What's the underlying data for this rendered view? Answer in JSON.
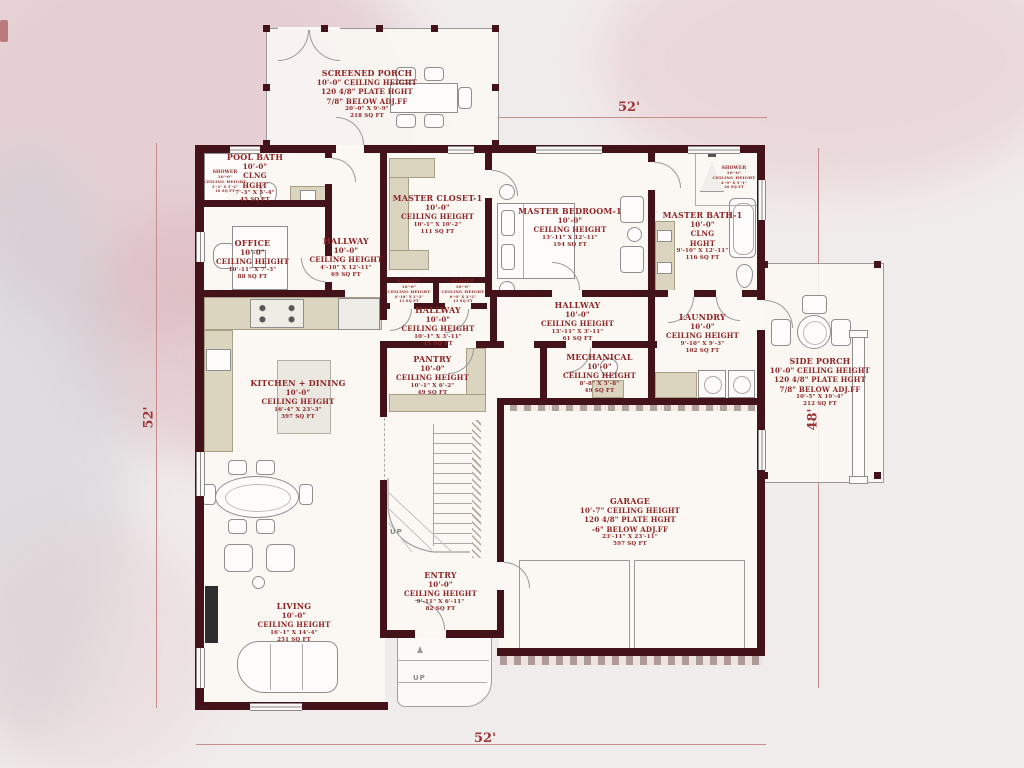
{
  "colors": {
    "wall": "#44131a",
    "label_text": "#8e2424",
    "dimension_text": "#9c3438",
    "counter": "#dbd5c0",
    "background": "#f1ecec"
  },
  "dimensions": {
    "top": "52'",
    "left": "52'",
    "right": "48'",
    "bottom": "52'"
  },
  "stairs": {
    "interior_up": "UP",
    "stoop_up": "UP"
  },
  "rooms": {
    "screened_porch": {
      "lines": [
        "SCREENED PORCH",
        "10'-0\" CEILING HEIGHT",
        "120 4/8\" PLATE HGHT",
        "7/8\" BELOW ADJ.FF",
        "20'-0\" X 9'-9\"",
        "218 SQ FT"
      ]
    },
    "pool_bath": {
      "lines": [
        "POOL BATH",
        "10'-0\"",
        "CLNG",
        "HGHT",
        "7'-3\" X 5'-4\"",
        "45 SQ FT"
      ]
    },
    "shower_pool": {
      "lines": [
        "SHOWER",
        "10'-0\"",
        "CEILING HEIGHT",
        "3'-2\" X 5'-2\"",
        "16 SQ FT"
      ]
    },
    "office": {
      "lines": [
        "OFFICE",
        "10'-0\"",
        "CEILING HEIGHT",
        "10'-11\" X 7'-3\"",
        "88 SQ FT"
      ]
    },
    "hallway_upper": {
      "lines": [
        "HALLWAY",
        "10'-0\"",
        "CEILING HEIGHT",
        "4'-10\" X 12'-11\"",
        "69 SQ FT"
      ]
    },
    "master_closet": {
      "lines": [
        "MASTER CLOSET-1",
        "10'-0\"",
        "CEILING HEIGHT",
        "10'-1\" X 10'-2\"",
        "111 SQ FT"
      ]
    },
    "closet_a": {
      "lines": [
        "CLOSET",
        "10'-0\"",
        "CEILING HEIGHT",
        "4'-10\" X 2'-2\"",
        "11 SQ FT"
      ]
    },
    "closet_b": {
      "lines": [
        "CLOSET",
        "10'-0\"",
        "CEILING HEIGHT",
        "6'-0\" X 2'-2\"",
        "13 SQ FT"
      ]
    },
    "master_bedroom": {
      "lines": [
        "MASTER BEDROOM-1",
        "10'-0\"",
        "CEILING HEIGHT",
        "13'-11\" X 12'-11\"",
        "194 SQ FT"
      ]
    },
    "master_bath": {
      "lines": [
        "MASTER BATH-1",
        "10'-0\"",
        "CLNG",
        "HGHT",
        "9'-10\" X 12'-11\"",
        "116 SQ FT"
      ]
    },
    "shower_master": {
      "lines": [
        "SHOWER",
        "10'-0\"",
        "CEILING HEIGHT",
        "4'-0\" X 5'-1\"",
        "20 SQ FT"
      ]
    },
    "hallway_west": {
      "lines": [
        "HALLWAY",
        "10'-0\"",
        "CEILING HEIGHT",
        "10'-1\" X 3'-11\"",
        "45 SQ FT"
      ]
    },
    "hallway_east": {
      "lines": [
        "HALLWAY",
        "10'-0\"",
        "CEILING HEIGHT",
        "13'-11\" X 3'-11\"",
        "61 SQ FT"
      ]
    },
    "laundry": {
      "lines": [
        "LAUNDRY",
        "10'-0\"",
        "CEILING HEIGHT",
        "9'-10\" X 9'-3\"",
        "102 SQ FT"
      ]
    },
    "pantry": {
      "lines": [
        "PANTRY",
        "10'-0\"",
        "CEILING HEIGHT",
        "10'-1\" X 6'-2\"",
        "49 SQ FT"
      ]
    },
    "mechanical": {
      "lines": [
        "MECHANICAL",
        "10'-0\"",
        "CEILING HEIGHT",
        "8'-8\" X 5'-8\"",
        "49 SQ FT"
      ]
    },
    "side_porch": {
      "lines": [
        "SIDE PORCH",
        "10'-0\" CEILING HEIGHT",
        "120 4/8\" PLATE HGHT",
        "7/8\" BELOW ADJ.FF",
        "10'-5\" X 19'-4\"",
        "212 SQ FT"
      ]
    },
    "kitchen_dining": {
      "lines": [
        "KITCHEN + DINING",
        "10'-0\"",
        "CEILING HEIGHT",
        "16'-4\" X 23'-3\"",
        "397 SQ FT"
      ]
    },
    "garage": {
      "lines": [
        "GARAGE",
        "10'-7\" CEILING HEIGHT",
        "120 4/8\" PLATE HGHT",
        "-6\" BELOW ADJ.FF",
        "23'-11\" X 23'-11\"",
        "597 SQ FT"
      ]
    },
    "entry": {
      "lines": [
        "ENTRY",
        "10'-0\"",
        "CEILING HEIGHT",
        "9'-11\" X 6'-11\"",
        "82 SQ FT"
      ]
    },
    "living": {
      "lines": [
        "LIVING",
        "10'-0\"",
        "CEILING HEIGHT",
        "16'-1\" X 14'-4\"",
        "251 SQ FT"
      ]
    }
  }
}
